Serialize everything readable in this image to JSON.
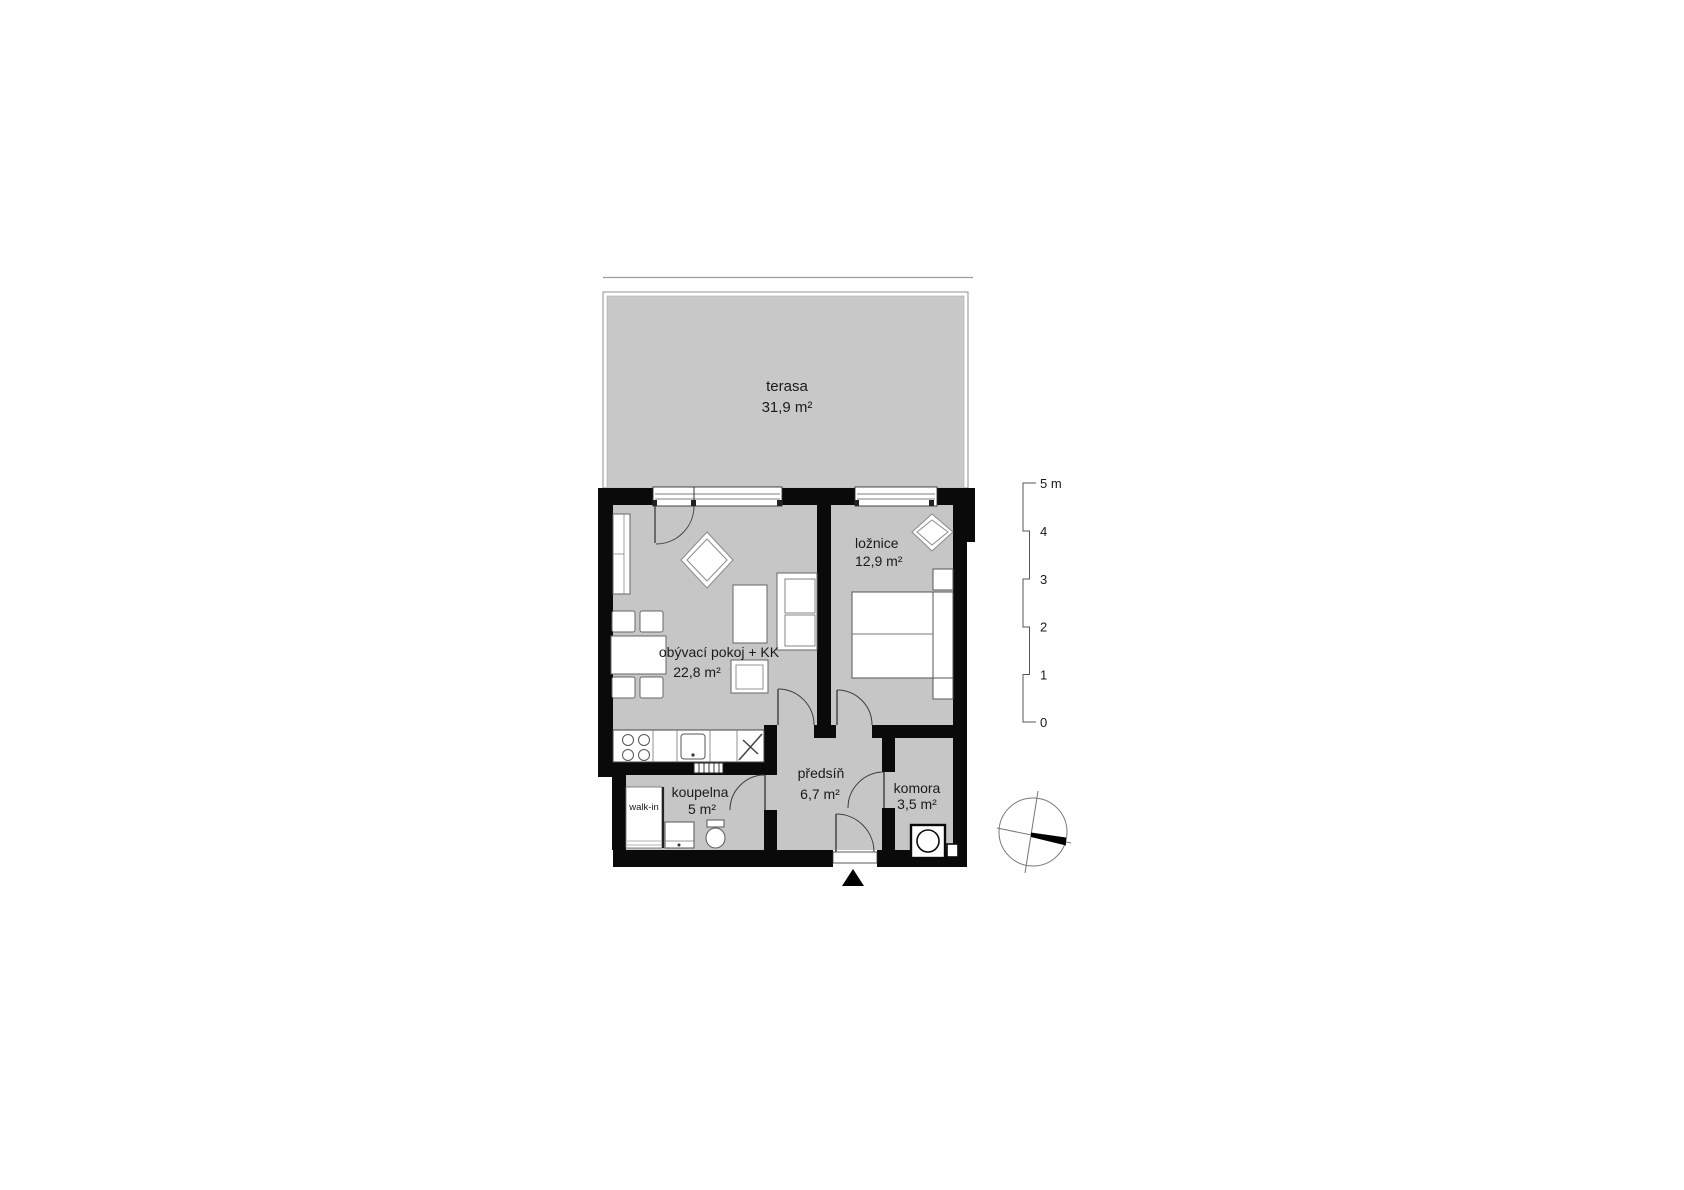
{
  "rooms": {
    "terasa": {
      "name": "terasa",
      "area": "31,9 m²"
    },
    "obyvaci": {
      "name": "obývací pokoj + KK",
      "area": "22,8 m²"
    },
    "loznice": {
      "name": "ložnice",
      "area": "12,9 m²"
    },
    "koupelna": {
      "name": "koupelna",
      "area": "5 m²"
    },
    "predsin": {
      "name": "předsíň",
      "area": "6,7 m²"
    },
    "komora": {
      "name": "komora",
      "area": "3,5 m²"
    },
    "walk_in": {
      "name": "walk-in"
    }
  },
  "scale_bar": {
    "unit_labels": [
      "5 m",
      "4",
      "3",
      "2",
      "1",
      "0"
    ]
  },
  "colors": {
    "floor": "#c6c6c6",
    "terrace_floor": "#c8c8c8",
    "wall": "#0a0a0a",
    "outline": "#555555",
    "text": "#1a1a1a"
  }
}
